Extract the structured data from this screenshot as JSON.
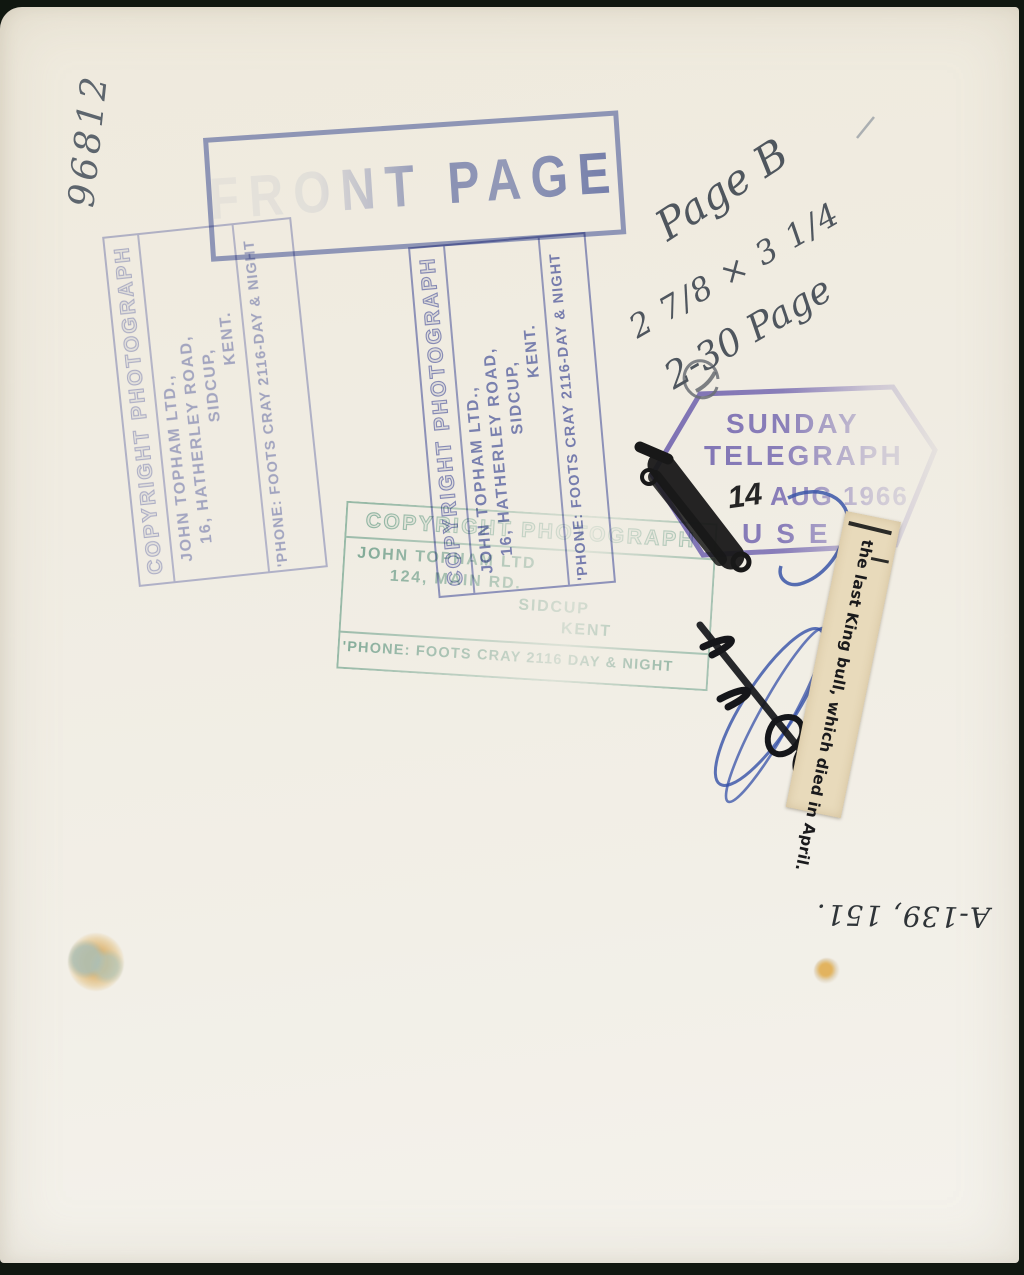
{
  "photo_back": {
    "reference_number": "96812",
    "front_page_stamp": {
      "label": "FRONT PAGE"
    },
    "topham_purple_stamp": {
      "title": "COPYRIGHT PHOTOGRAPH",
      "company": "JOHN TOPHAM LTD.,",
      "street": "16, HATHERLEY ROAD,",
      "town": "SIDCUP,",
      "county": "KENT.",
      "phone": "'PHONE: FOOTS CRAY 2116-DAY & NIGHT"
    },
    "topham_green_stamp": {
      "title": "COPYRIGHT PHOTOGRAPH",
      "company": "JOHN TOPHAM LTD",
      "street": "124, MAIN RD.",
      "town": "SIDCUP",
      "county": "KENT",
      "phone": "'PHONE: FOOTS CRAY 2116 DAY & NIGHT"
    },
    "telegraph_stamp": {
      "paper_line1": "SUNDAY",
      "paper_line2": "TELEGRAPH",
      "date_day": "14",
      "date_month_year": "AUG 1966",
      "status": "USED"
    },
    "clipping_caption": "the last King bull, which died in April.",
    "annotations": {
      "page_note": "Page B",
      "print_size": "2 7/8 × 3 1/4",
      "time_page_note": "2-30 Page",
      "archive_number": "A-139, 151."
    }
  },
  "colors": {
    "stamp_blue": "#4d5eac",
    "stamp_purple": "#646eb9",
    "stamp_green": "#6eaa98",
    "telegraph_purple": "#7a6ec6",
    "paper": "#f0ece2",
    "clipping_paper": "#e8dabb"
  }
}
